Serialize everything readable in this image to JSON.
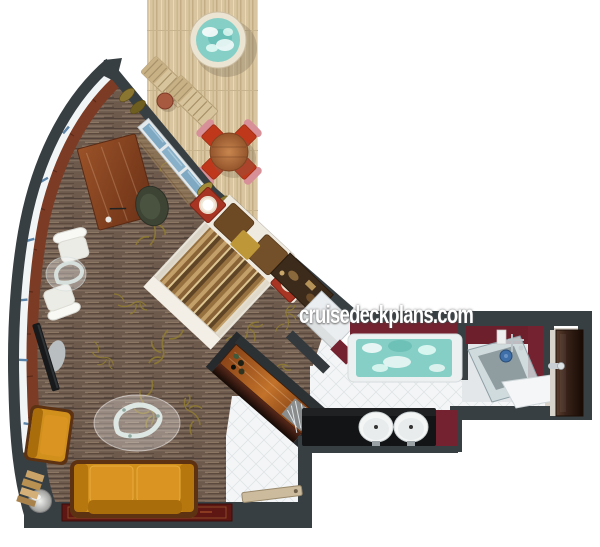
{
  "watermark": {
    "text": "cruisedeckplans.com"
  },
  "floorplan": {
    "type": "cruise-suite-top-down-floorplan",
    "rooms": [
      {
        "name": "balcony",
        "features": [
          "hot-tub",
          "lounger",
          "lounger",
          "side-table",
          "dining-table",
          "four-dining-chairs",
          "wood-deck"
        ]
      },
      {
        "name": "living-room",
        "features": [
          "desk",
          "desk-chair",
          "tv",
          "white-armchair",
          "white-armchair",
          "glass-side-table",
          "sofa",
          "orange-armchair",
          "ottoman",
          "coffee-table",
          "runner-rug",
          "bar-cabinet",
          "towel-shelf"
        ]
      },
      {
        "name": "bedroom",
        "features": [
          "double-bed",
          "nightstand-lamp",
          "nightstand-lamp",
          "headboard",
          "wardrobe",
          "curtains",
          "sliding-glass-door"
        ]
      },
      {
        "name": "bathroom",
        "features": [
          "bathtub",
          "double-sink-vanity",
          "shower",
          "white-counter",
          "wood-entrance-door"
        ]
      },
      {
        "name": "entry",
        "features": [
          "tile-floor",
          "door-leaf"
        ]
      }
    ],
    "colors": {
      "wall": "#373f43",
      "deck_wood": "#d9c6a0",
      "carpet": "#6d5a4d",
      "water": "#85cfc6",
      "accent_wall_red": "#74222f",
      "sofa_orange": "#d18f1c",
      "tile": "#f3f5f6"
    }
  }
}
